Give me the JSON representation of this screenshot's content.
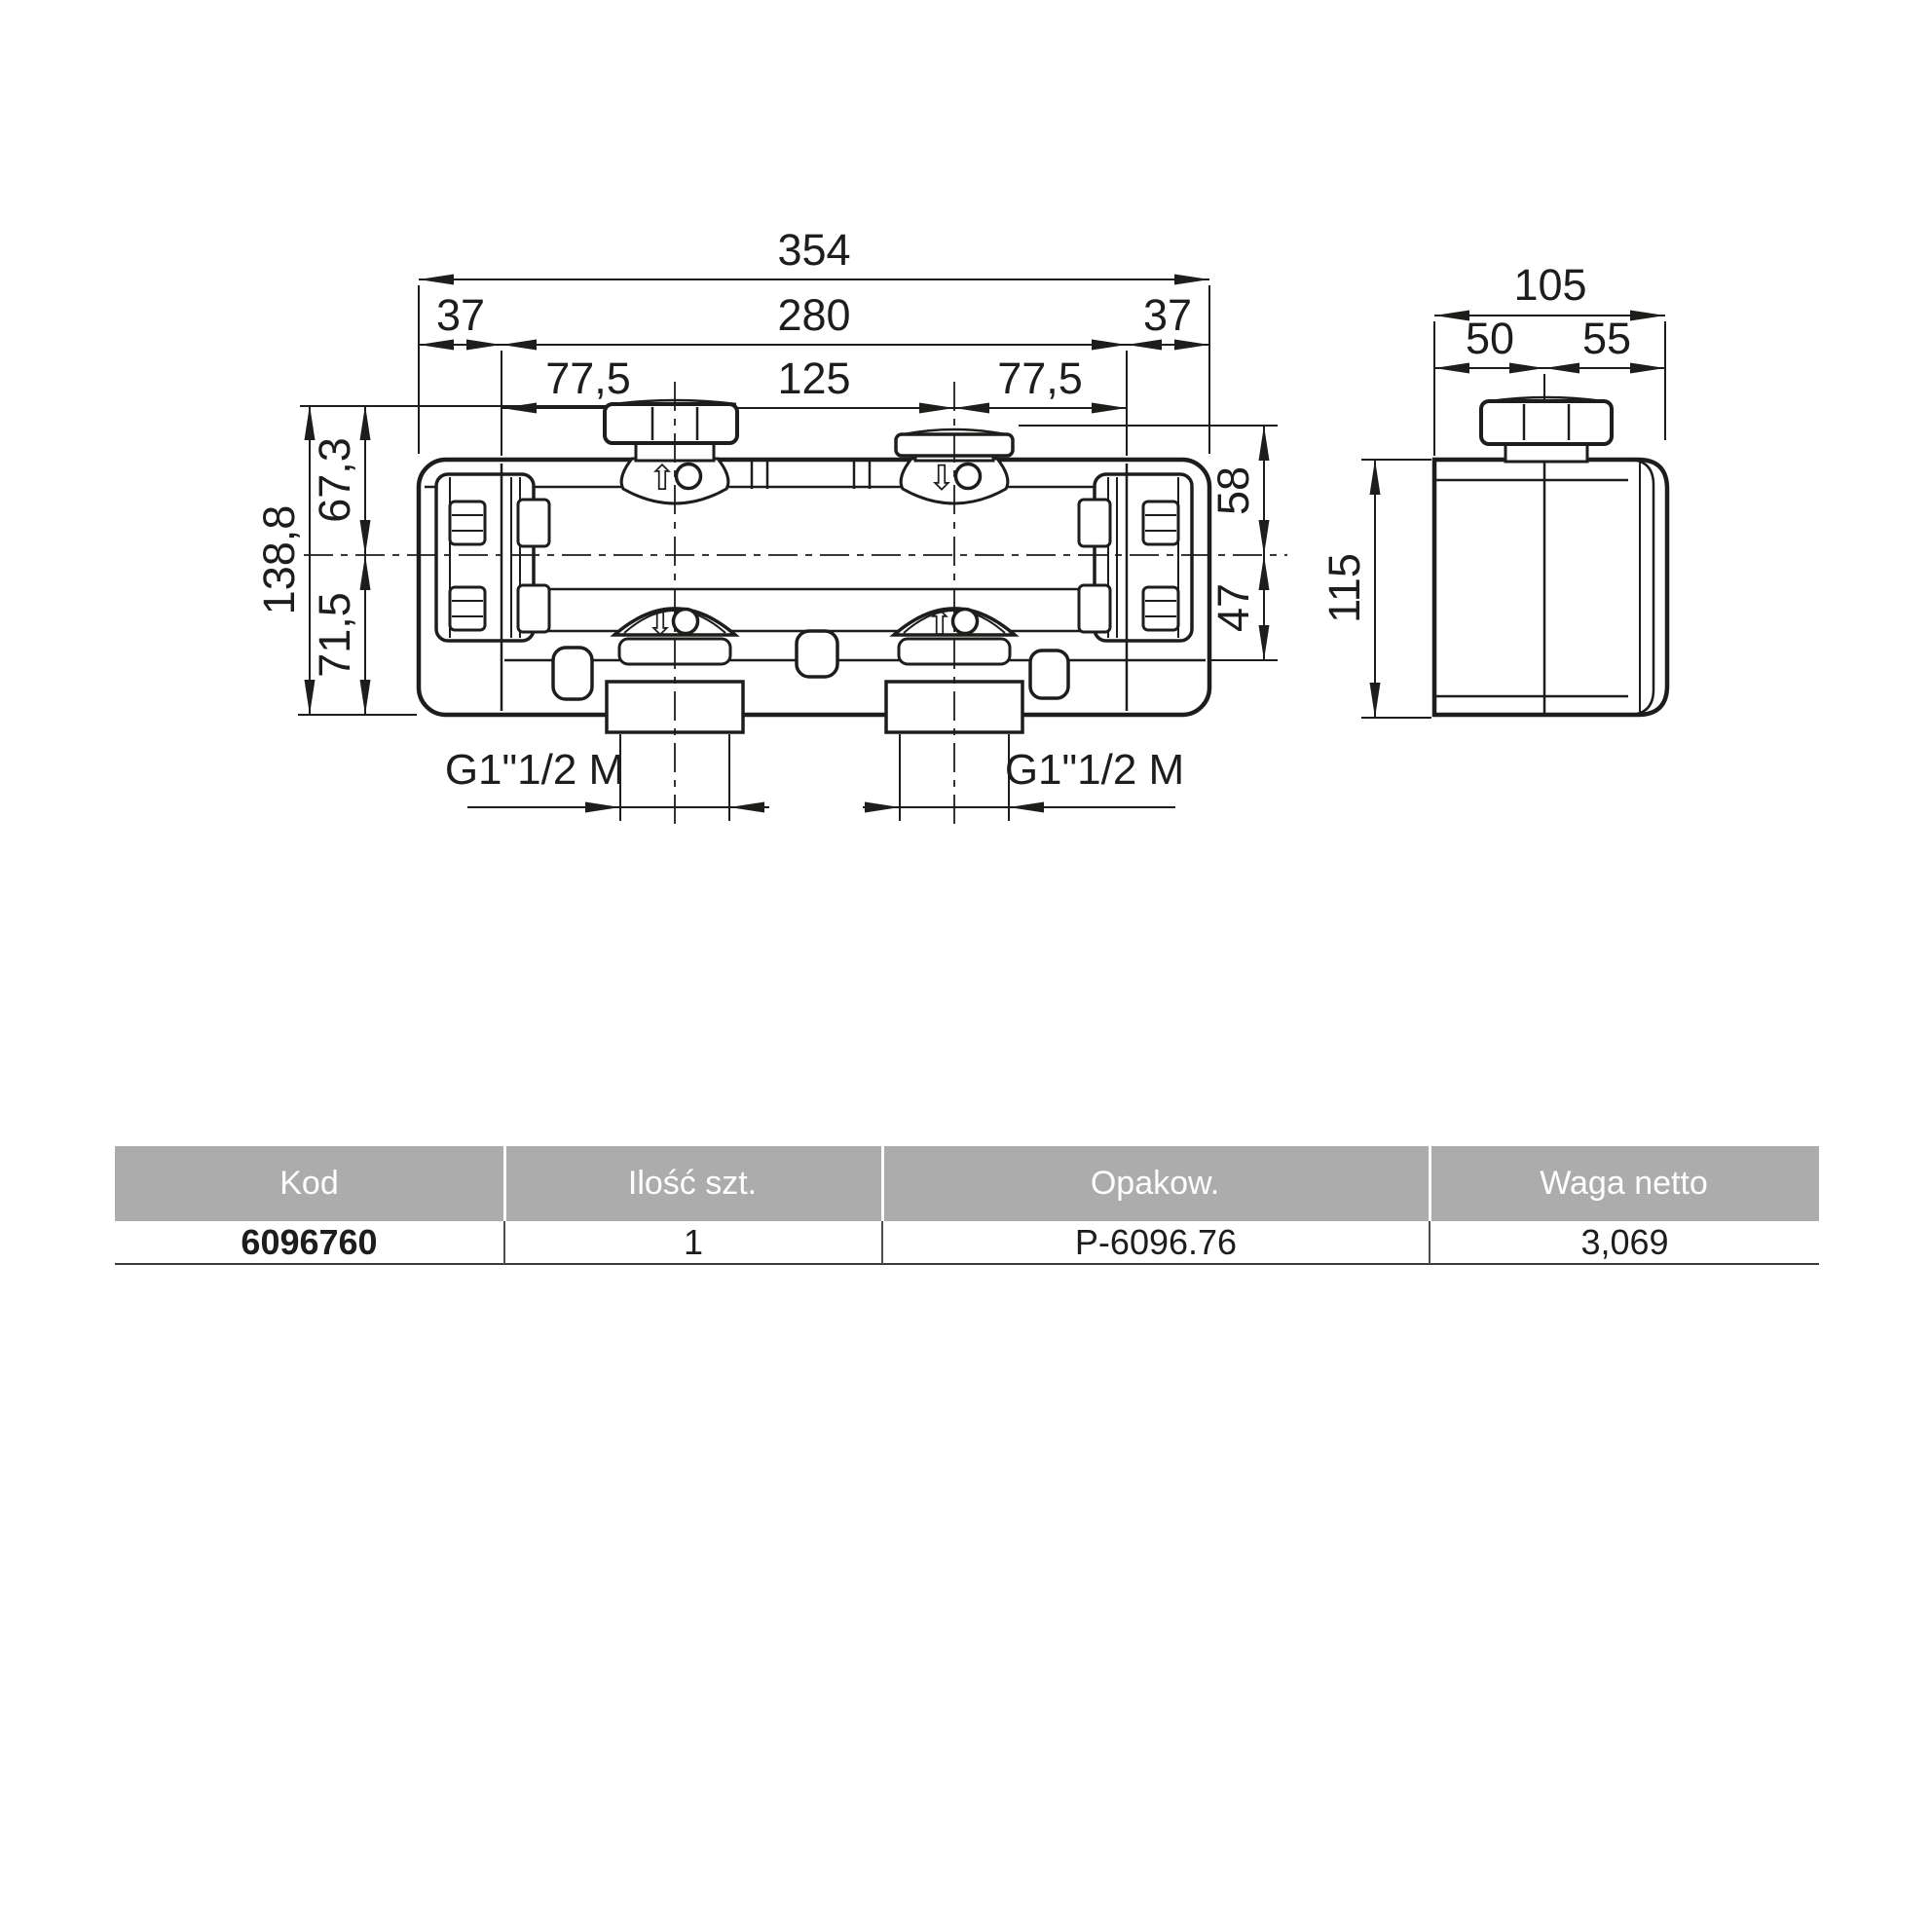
{
  "front_view": {
    "dims": {
      "total_width": "354",
      "side_left": "37",
      "center_width": "280",
      "side_right": "37",
      "port_offset_left": "77,5",
      "port_spacing": "125",
      "port_offset_right": "77,5",
      "height_total": "138,8",
      "center_to_top": "67,3",
      "center_to_bottom": "71,5",
      "cap_to_center": "58",
      "center_to_base": "47",
      "thread_left": "G1\"1/2 M",
      "thread_right": "G1\"1/2 M"
    },
    "ports": {
      "top_left_symbol": "⇧",
      "top_right_symbol": "⇩",
      "bottom_left_symbol": "⇩",
      "bottom_right_symbol": "⇧"
    }
  },
  "side_view": {
    "dims": {
      "depth_total": "105",
      "depth_front": "50",
      "depth_back": "55",
      "height": "115"
    }
  },
  "table": {
    "headers": [
      "Kod",
      "Ilość szt.",
      "Opakow.",
      "Waga netto"
    ],
    "rows": [
      [
        "6096760",
        "1",
        "P-6096.76",
        "3,069"
      ]
    ]
  },
  "colors": {
    "line": "#1d1d1b",
    "table_header_bg": "#acacac",
    "table_header_text": "#ffffff"
  }
}
